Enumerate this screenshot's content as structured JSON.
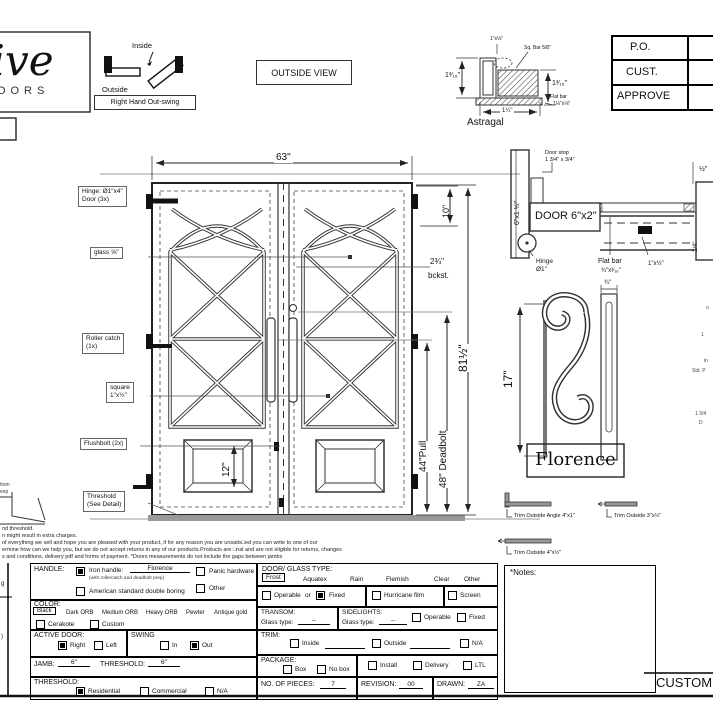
{
  "logo": {
    "script": "sive",
    "sub": "DOORS"
  },
  "swing": {
    "inside": "Inside",
    "outside": "Outside",
    "label": "Right Hand Out-swing"
  },
  "outside_view": "OUTSIDE VIEW",
  "titleblock": {
    "po": "P.O.",
    "cust": "CUST.",
    "approve": "APPROVE"
  },
  "astragal": {
    "title": "Astragal",
    "top_label": "1\"x⅛\"",
    "sq_bar": "Sq. Bar 5/8\"",
    "left": "1³⁄₁₆\"",
    "right": "1³⁄₁₆\"",
    "bottom": "1¼\"",
    "flat1": "Flat bar",
    "flat2": "1⅛\"x⅛\""
  },
  "elevation": {
    "labels": {
      "hinge1": "Hinge: Ø1\"x4\"",
      "hinge2": "Door (3x)",
      "glass": "glass ⅝\"",
      "roller1": "Roller catch",
      "roller2": "(1x)",
      "square1": "square",
      "square2": "1\"x½\"",
      "flushbolt": "Flushbolt (2x)",
      "threshold1": "Threshold",
      "threshold2": "(See Detail)"
    },
    "dims": {
      "width": "63\"",
      "top": "10\"",
      "backset": "2¾\"",
      "backset_sub": "bckst.",
      "pull": "44\"Pull",
      "deadbolt": "48\" Deadbolt",
      "height": "81½\"",
      "panel": "12\""
    }
  },
  "section": {
    "jamb": "6\"x1 ½\"",
    "stop1": "Door stop",
    "stop2": "1 3/4\" x 3/4\"",
    "door": "DOOR 6\"x2\"",
    "hinge1": "Hinge",
    "hinge2": "Ø1\"",
    "flat1": "Flat bar",
    "flat2": "¾\"x³⁄₁₆\"",
    "bar": "1\"x½\"",
    "d34": "3/4\"",
    "dhalf": "½\""
  },
  "handle": {
    "height": "17\"",
    "width": "¾\"",
    "name": "Florence"
  },
  "trim": {
    "t1": "Trim Outside Angle 4\"x1\"",
    "t2": "Trim Outside 3\"x½\"",
    "t3": "Trim Outside 4\"x½\""
  },
  "fineprint": {
    "lines": [
      "nd threshold.",
      "n might result in extra charges.",
      "of everything we sell and hope you are pleased with your product, if for any reason you are unsatis□ed you can write to one of our",
      "ermine how can we help you, but we do not accept returns in any of our products.Products are □nal and are not eligible for returns, changes",
      "s and conditions, delivery pdf and forms of payment. *Doors measurements do not include the gaps between jambs"
    ]
  },
  "fragments": {
    "a": "g",
    "b": ")",
    "c": "ttom",
    "d": "eep",
    "e": "o",
    "f": "1",
    "g": "in",
    "h": "Std. P",
    "i": "1 3/4",
    "j": "D"
  },
  "form": {
    "handle": {
      "label": "HANDLE:",
      "iron": "Iron handle:",
      "iron_value": "Florence",
      "iron_note": "(with rollercatch and deadbolt prep)",
      "american": "American standard double boring",
      "panic": "Panic hardware",
      "other": "Other"
    },
    "color": {
      "label": "COLOR:",
      "options": [
        "Black",
        "Dark ORB",
        "Medium ORB",
        "Heavy ORB",
        "Pewter",
        "Antique gold"
      ],
      "cerakote": "Cerakote",
      "custom": "Custom"
    },
    "active_door": {
      "label": "ACTIVE DOOR:",
      "right": "Right",
      "left": "Left"
    },
    "swing": {
      "label": "SWING",
      "in": "In",
      "out": "Out"
    },
    "jamb": {
      "label": "JAMB:",
      "value": "6\"",
      "t_label": "THRESHOLD:",
      "t_value": "6\""
    },
    "threshold": {
      "label": "THRESHOLD:",
      "residential": "Residential",
      "commercial": "Commercial",
      "na": "N/A"
    },
    "glass": {
      "label": "DOOR/ GLASS TYPE:",
      "options": [
        "Frost",
        "Aquatex",
        "Rain",
        "Flemish",
        "Clear",
        "Other"
      ]
    },
    "mode": {
      "operable": "Operable",
      "or": "or",
      "fixed": "Fixed",
      "hurricane": "Hurricane film",
      "screen": "Screen"
    },
    "transom": {
      "label": "TRANSOM:",
      "glass_type": "Glass type:",
      "value": "--"
    },
    "sidelights": {
      "label": "SIDELIGHTS:",
      "glass_type": "Glass type:",
      "value": "--",
      "operable": "Operable",
      "fixed": "Fixed"
    },
    "trim": {
      "label": "TRIM:",
      "inside": "Inside",
      "outside": "Outside",
      "na": "N/A"
    },
    "package": {
      "label": "PACKAGE:",
      "box": "Box",
      "no_box": "No box",
      "install": "Install",
      "delivery": "Delivery",
      "ltl": "LTL"
    },
    "pieces": {
      "label": "NO. OF PIECES:",
      "value": "7"
    },
    "revision": {
      "label": "REVISION:",
      "value": "00"
    },
    "drawn": {
      "label": "DRAWN:",
      "value": "ZA"
    },
    "notes_label": "*Notes:",
    "customer": "CUSTOM"
  },
  "checks": {
    "iron": true,
    "american": false,
    "panic": false,
    "other": false,
    "cerakote": false,
    "custom": false,
    "right": true,
    "left": false,
    "in": false,
    "out": true,
    "residential": true,
    "commercial": false,
    "na": false,
    "operable": false,
    "fixed": true,
    "hurricane": false,
    "screen": false,
    "sl_operable": false,
    "sl_fixed": false,
    "trim_inside": false,
    "trim_outside": false,
    "trim_na": false,
    "box": false,
    "no_box": false,
    "install": false,
    "delivery": false,
    "ltl": false
  }
}
